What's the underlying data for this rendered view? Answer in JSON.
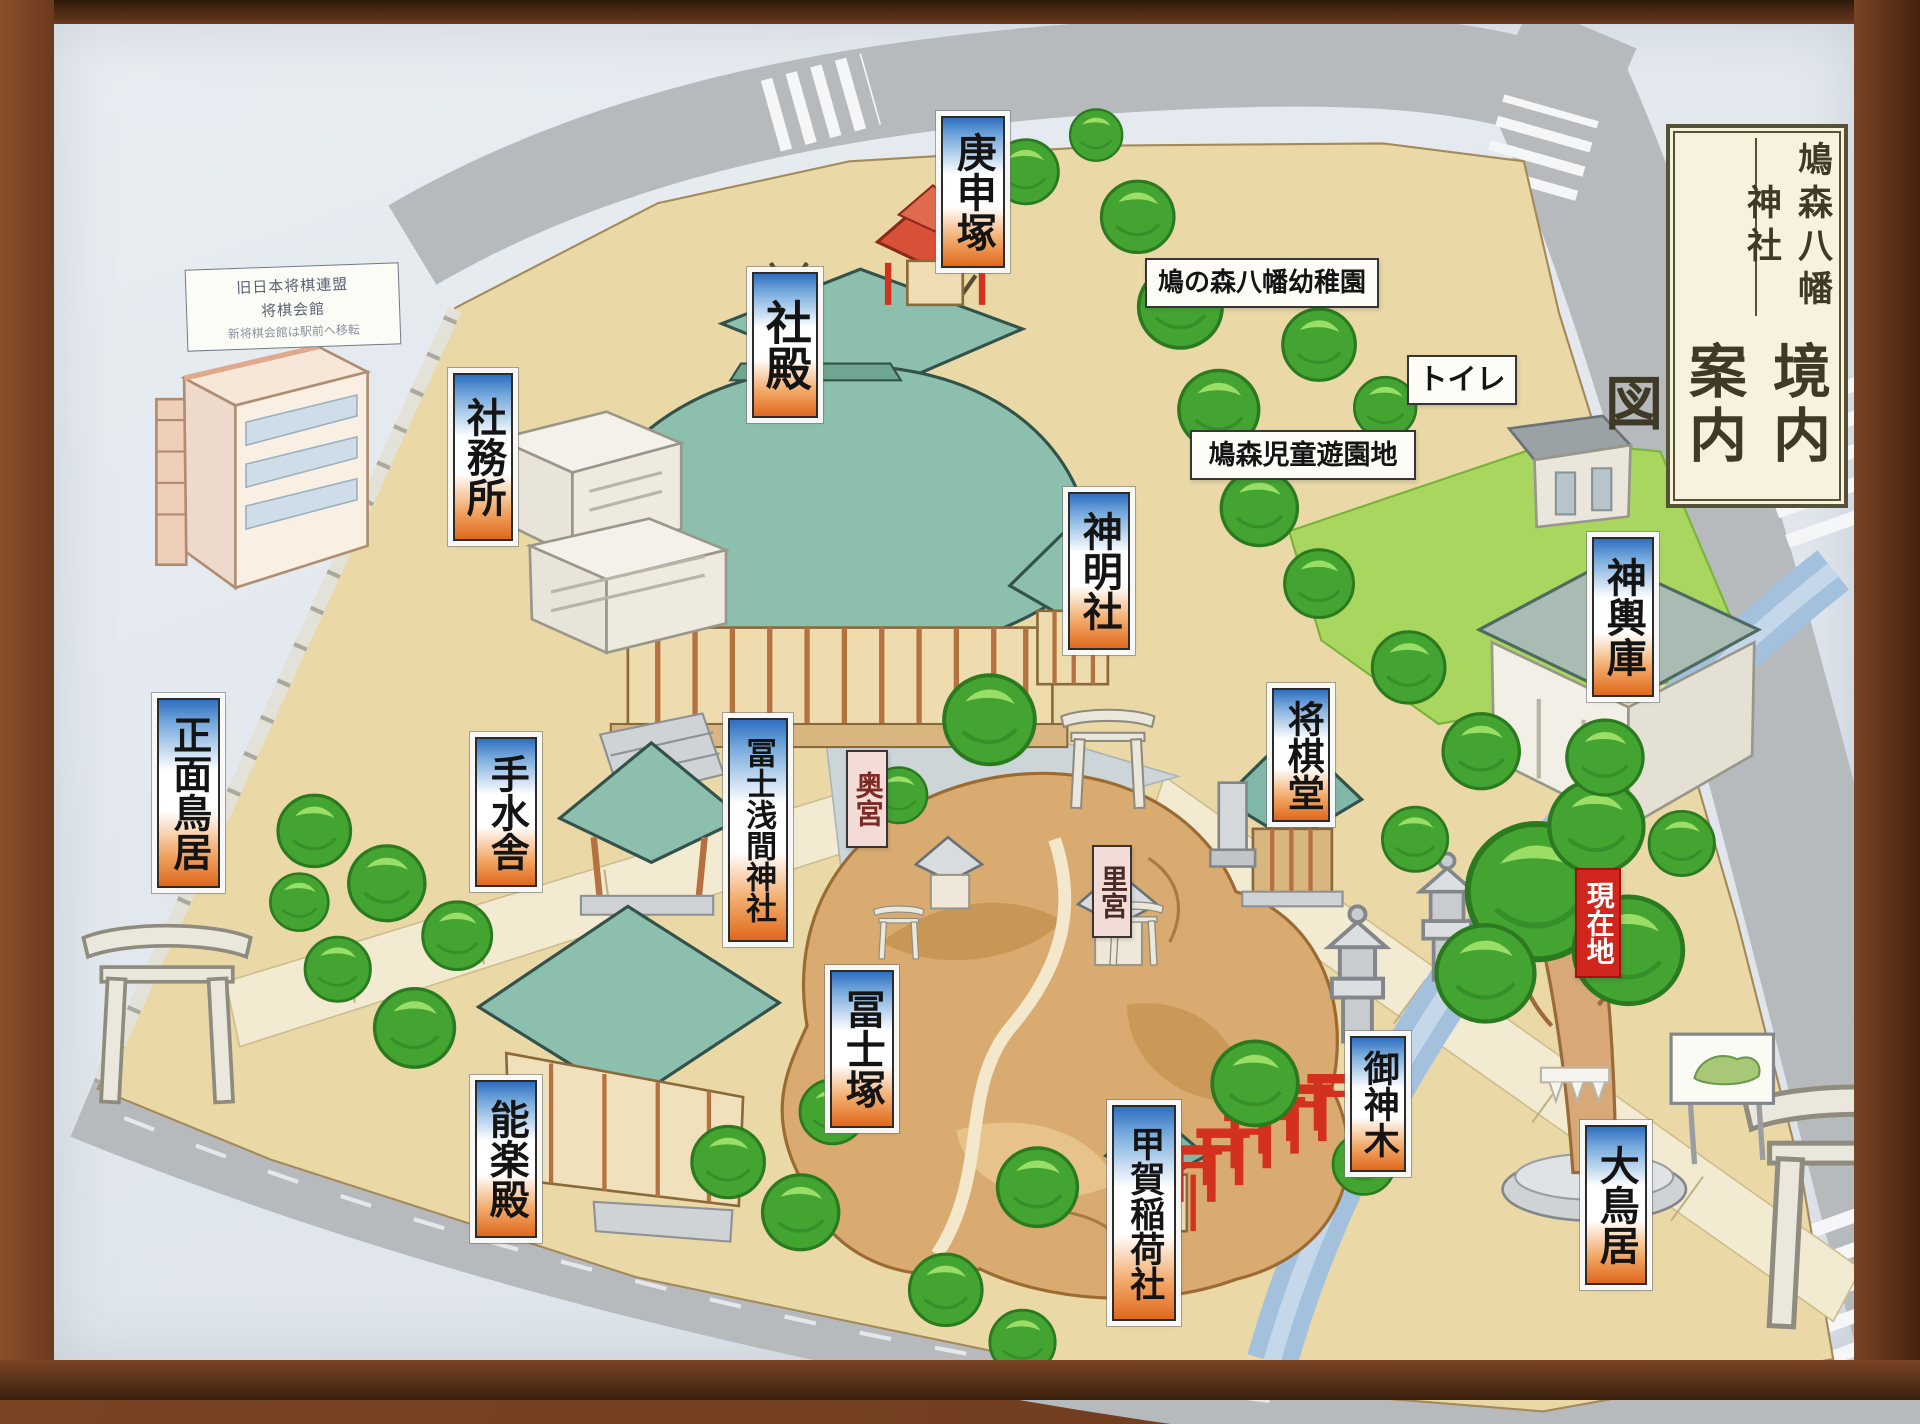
{
  "title": {
    "shrine": "鳩森八幡神社",
    "map": "境内案内図"
  },
  "note": {
    "line1": "旧日本将棋連盟",
    "line2": "将棋会館",
    "line3": "新将棋会館は駅前へ移転"
  },
  "colors": {
    "label_gradient_top": "#2e6fc0",
    "label_gradient_bottom": "#e0681c",
    "current_location_red": "#d0261e",
    "pink_label": "#f3dcd8",
    "grounds_beige": "#ead9a6",
    "lawn_green": "#a8d65f",
    "roof_teal": "#8cbfad",
    "tree_green": "#43a432",
    "mound_tan": "#d9ab70",
    "road_gray": "#b7babd",
    "stream_blue": "#a3c1dc",
    "frame_wood": "#6b3a1c"
  },
  "labels": [
    {
      "name": "koshinzuka",
      "text": "庚申塚",
      "style": "gradient",
      "orient": "v",
      "x": 941,
      "y": 116,
      "w": 64,
      "h": 152,
      "fs": 40
    },
    {
      "name": "shaden",
      "text": "社殿",
      "style": "gradient",
      "orient": "v",
      "x": 752,
      "y": 272,
      "w": 66,
      "h": 146,
      "fs": 46
    },
    {
      "name": "shamusho",
      "text": "社務所",
      "style": "gradient",
      "orient": "v",
      "x": 453,
      "y": 373,
      "w": 60,
      "h": 168,
      "fs": 40
    },
    {
      "name": "shinmeisha",
      "text": "神明社",
      "style": "gradient",
      "orient": "v",
      "x": 1068,
      "y": 492,
      "w": 62,
      "h": 158,
      "fs": 40
    },
    {
      "name": "mikoshiko",
      "text": "神輿庫",
      "style": "gradient",
      "orient": "v",
      "x": 1592,
      "y": 537,
      "w": 62,
      "h": 160,
      "fs": 40
    },
    {
      "name": "shogido",
      "text": "将棋堂",
      "style": "gradient",
      "orient": "v",
      "x": 1272,
      "y": 688,
      "w": 58,
      "h": 134,
      "fs": 37
    },
    {
      "name": "shomen-torii",
      "text": "正面鳥居",
      "style": "gradient",
      "orient": "v",
      "x": 157,
      "y": 698,
      "w": 63,
      "h": 190,
      "fs": 39
    },
    {
      "name": "temizusha",
      "text": "手水舎",
      "style": "gradient",
      "orient": "v",
      "x": 475,
      "y": 737,
      "w": 62,
      "h": 150,
      "fs": 39
    },
    {
      "name": "fuji-sengen-jinja",
      "text": "冨士浅間神社",
      "style": "gradient",
      "orient": "v",
      "x": 728,
      "y": 718,
      "w": 60,
      "h": 224,
      "fs": 31
    },
    {
      "name": "okumiya",
      "text": "奥宮",
      "style": "pink",
      "orient": "v",
      "x": 846,
      "y": 750,
      "w": 42,
      "h": 98,
      "fs": 28,
      "color": "#7c2a24"
    },
    {
      "name": "satomiya",
      "text": "里宮",
      "style": "pink",
      "orient": "v",
      "x": 1092,
      "y": 845,
      "w": 40,
      "h": 93,
      "fs": 27,
      "color": "#4a2a24"
    },
    {
      "name": "fujizuka",
      "text": "冨士塚",
      "style": "gradient",
      "orient": "v",
      "x": 830,
      "y": 970,
      "w": 64,
      "h": 158,
      "fs": 40
    },
    {
      "name": "nogakuden",
      "text": "能楽殿",
      "style": "gradient",
      "orient": "v",
      "x": 475,
      "y": 1080,
      "w": 62,
      "h": 158,
      "fs": 40
    },
    {
      "name": "koga-inarisha",
      "text": "甲賀稲荷社",
      "style": "gradient",
      "orient": "v",
      "x": 1112,
      "y": 1105,
      "w": 64,
      "h": 216,
      "fs": 35
    },
    {
      "name": "goshinboku",
      "text": "御神木",
      "style": "gradient",
      "orient": "v",
      "x": 1350,
      "y": 1036,
      "w": 56,
      "h": 136,
      "fs": 36
    },
    {
      "name": "genzaichi",
      "text": "現在地",
      "style": "red",
      "orient": "v",
      "x": 1575,
      "y": 868,
      "w": 46,
      "h": 110,
      "fs": 28
    },
    {
      "name": "otorii",
      "text": "大鳥居",
      "style": "gradient",
      "orient": "v",
      "x": 1585,
      "y": 1125,
      "w": 62,
      "h": 160,
      "fs": 40
    },
    {
      "name": "kindergarten",
      "text": "鳩の森八幡幼稚園",
      "style": "plain",
      "orient": "h",
      "x": 1145,
      "y": 258,
      "w": 234,
      "h": 50,
      "fs": 26
    },
    {
      "name": "toilet",
      "text": "トイレ",
      "style": "plain",
      "orient": "h",
      "x": 1407,
      "y": 355,
      "w": 110,
      "h": 50,
      "fs": 29
    },
    {
      "name": "playground",
      "text": "鳩森児童遊園地",
      "style": "plain",
      "orient": "h",
      "x": 1190,
      "y": 430,
      "w": 226,
      "h": 50,
      "fs": 27
    }
  ]
}
